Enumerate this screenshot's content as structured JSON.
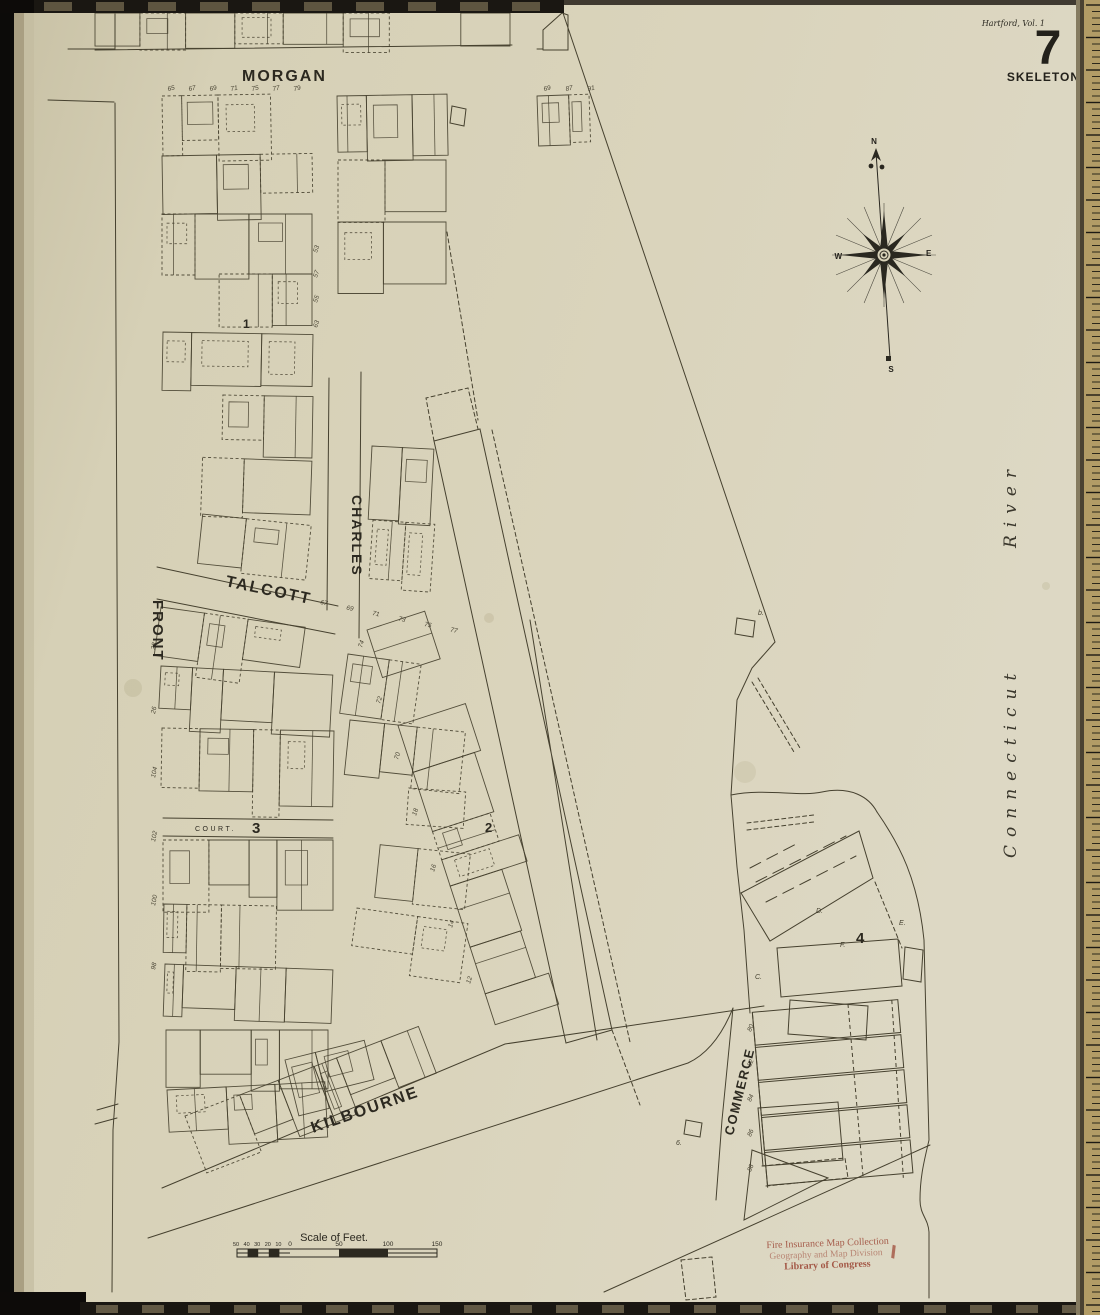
{
  "header": {
    "volume_note": "Hartford, Vol. 1",
    "sheet_number": "7",
    "map_type": "SKELETON"
  },
  "compass": {
    "north": "N",
    "south": "S",
    "east": "E",
    "west": "W"
  },
  "labels": {
    "river_word1": "Connecticut",
    "river_word2": "River",
    "streets": {
      "morgan": "MORGAN",
      "front": "FRONT",
      "talcott": "TALCOTT",
      "charles": "CHARLES",
      "court": "COURT.",
      "kilbourne": "KILBOURNE",
      "commerce": "COMMERCE"
    }
  },
  "block_numbers": [
    "1",
    "2",
    "3",
    "4"
  ],
  "building_letters": {
    "d": "D.",
    "e": "E.",
    "f": "F.",
    "c": "C.",
    "b": "b.",
    "six": "6."
  },
  "house_numbers": {
    "morgan_left": [
      "65",
      "67",
      "69",
      "71",
      "75",
      "77",
      "79"
    ],
    "morgan_right": [
      "69",
      "87",
      "91"
    ],
    "talcott": [
      "67",
      "69",
      "71",
      "73",
      "75",
      "77"
    ],
    "block2_left": [
      "74",
      "72",
      "70",
      "18",
      "16",
      "14",
      "12"
    ],
    "front_left": [
      "28",
      "26",
      "104",
      "102",
      "100",
      "98"
    ],
    "block1_right": [
      "53",
      "57",
      "55",
      "63"
    ],
    "commerce_piers": [
      "80",
      "82",
      "84",
      "86",
      "88"
    ]
  },
  "scale": {
    "title": "Scale of Feet.",
    "left_labels": [
      "50",
      "40",
      "30",
      "20",
      "10"
    ],
    "zero": "0",
    "right_labels": [
      "50",
      "100",
      "150"
    ]
  },
  "stamp": {
    "line1": "Fire Insurance Map Collection",
    "line2": "Geography and Map Division",
    "line3": "Library of Congress"
  },
  "colors": {
    "paper": "#d8d2b9",
    "ink": "#46412f",
    "stamp_red": "#9a4231",
    "ruler_tan": "#b29c66"
  }
}
